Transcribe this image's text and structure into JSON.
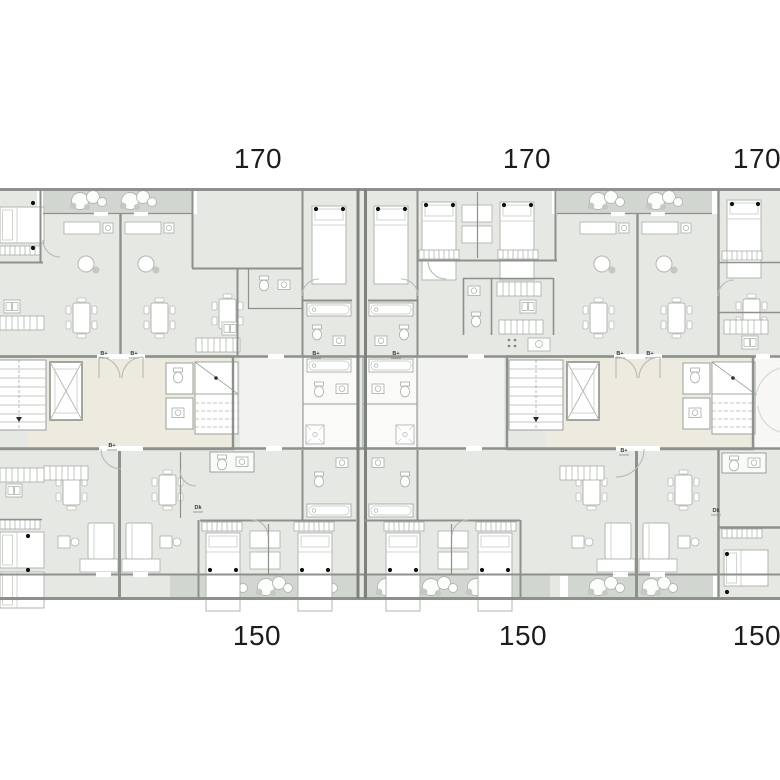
{
  "drawing": {
    "type": "architectural-floor-plan",
    "description": "Typical floor plan of a residential slab building with two stair cores, upper apartments labeled 170 and lower apartments labeled 150",
    "palette": {
      "background": "#ffffff",
      "room_fill": "#e6e8e4",
      "balcony_fill": "#d2d6d0",
      "lobby_fill": "#edeadf",
      "wall": "#8d918c",
      "wall_dark": "#7e827d",
      "furniture_stroke": "#b2b6b0",
      "light_line": "#c6cac4",
      "label_text": "#1c1c1c"
    },
    "unit_labels_top": [
      {
        "text": "170"
      },
      {
        "text": "170"
      },
      {
        "text": "170"
      }
    ],
    "unit_labels_bottom": [
      {
        "text": "150"
      },
      {
        "text": "150"
      },
      {
        "text": "150"
      }
    ],
    "door_tags": [
      {
        "text": "B+"
      },
      {
        "text": "B+"
      },
      {
        "text": "B+"
      },
      {
        "text": "B+"
      },
      {
        "text": "B+"
      },
      {
        "text": "B+"
      },
      {
        "text": "B+"
      },
      {
        "text": "B+"
      },
      {
        "text": "Dk"
      },
      {
        "text": "Dk"
      }
    ]
  }
}
